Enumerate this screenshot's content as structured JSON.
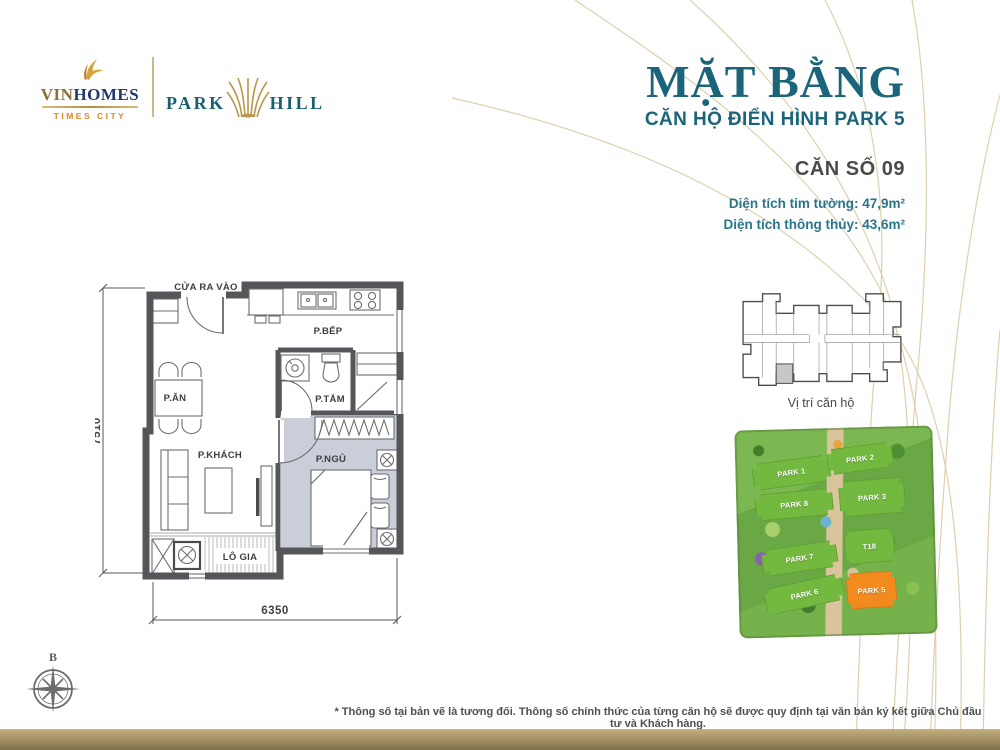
{
  "header": {
    "vinhomes": {
      "vin": "VIN",
      "homes": "HOMES",
      "tagline": "TIMES CITY"
    },
    "parkhill": {
      "park": "PARK",
      "hill": "HILL"
    },
    "title": "MẶT BẰNG",
    "subtitle": "CĂN HỘ ĐIỂN HÌNH PARK 5"
  },
  "unit": {
    "number": "CĂN SỐ 09",
    "area_gross": "Diện tích tim tường: 47,9m²",
    "area_net": "Diện tích thông thủy: 43,6m²"
  },
  "floor_plan": {
    "entrance": "CỬA RA VÀO",
    "kitchen": "P.BẾP",
    "dining": "P.ĂN",
    "bathroom": "P.TẮM",
    "living": "P.KHÁCH",
    "bedroom": "P.NGỦ",
    "loggia": "LÔ GIA",
    "dim_height": "7510",
    "dim_width": "6350"
  },
  "location": {
    "caption": "Vị trí căn hộ"
  },
  "site_map": {
    "buildings": [
      {
        "name": "PARK 1",
        "highlight": false
      },
      {
        "name": "PARK 2",
        "highlight": false
      },
      {
        "name": "PARK 8",
        "highlight": false
      },
      {
        "name": "PARK 3",
        "highlight": false
      },
      {
        "name": "PARK 7",
        "highlight": false
      },
      {
        "name": "T18",
        "highlight": false
      },
      {
        "name": "PARK 6",
        "highlight": false
      },
      {
        "name": "PARK 5",
        "highlight": true
      }
    ]
  },
  "compass": {
    "north": "B"
  },
  "footnote": "* Thông số tại bản vẽ là tương đối. Thông số chính thức của từng căn hộ sẽ được quy định tại văn bản ký kết giữa Chủ đầu tư và Khách hàng.",
  "colors": {
    "teal": "#1a6579",
    "curve_gold": "#dccaa7",
    "wall_gray": "#54565a",
    "bedroom_fill": "#c9ced8",
    "block_green": "#74b93f",
    "block_orange": "#f28a1d",
    "bar_tan": "#a59365"
  }
}
